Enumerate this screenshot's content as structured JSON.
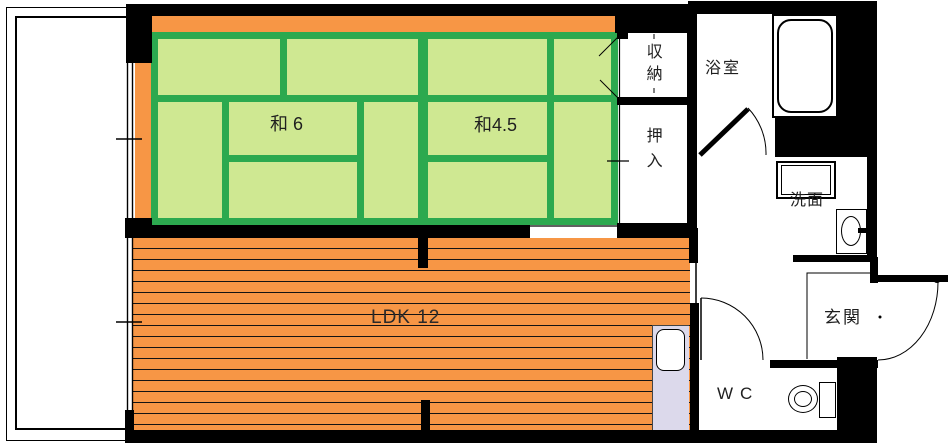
{
  "rooms": {
    "japanese_room_6": {
      "label": "和6"
    },
    "japanese_room_4_5": {
      "label": "和4.5"
    },
    "ldk": {
      "label": "LDK 12"
    },
    "storage": {
      "label": "収納"
    },
    "closet": {
      "label": "押入"
    },
    "bathroom": {
      "label": "浴室"
    },
    "washroom": {
      "label": "洗面"
    },
    "entrance": {
      "label": "玄関"
    },
    "wc": {
      "label": "WC"
    }
  },
  "colors": {
    "wall": "#000000",
    "tatami_fill": "#cfe892",
    "tatami_grid": "#2ca94f",
    "flooring": "#f79645",
    "flooring_stripe": "#141414",
    "counter": "#dcd9eb",
    "label_text": "#1f1f1f",
    "background": "#ffffff"
  }
}
